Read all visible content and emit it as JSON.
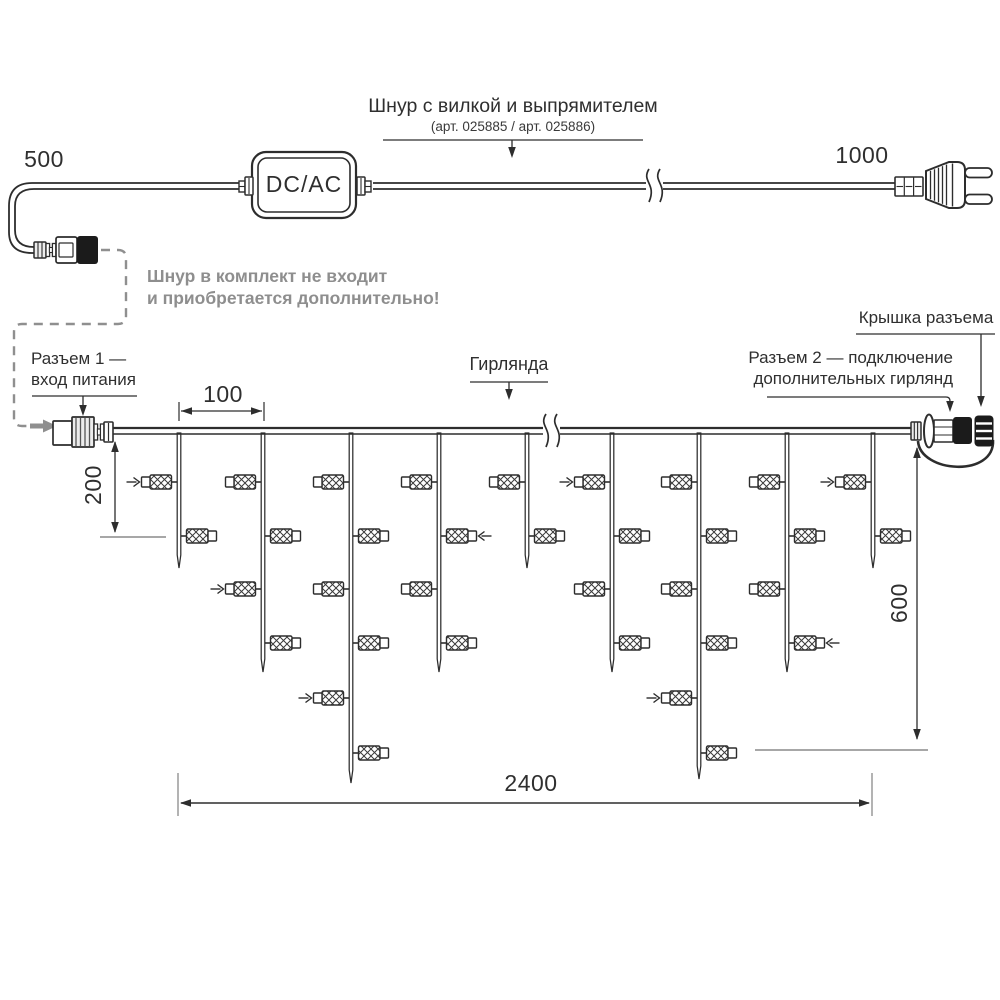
{
  "labels": {
    "cord_title": "Шнур с вилкой и выпрямителем",
    "cord_subtitle": "(арт. 025885 / арт. 025886)",
    "adapter": "DC/AC",
    "dim_500": "500",
    "dim_1000": "1000",
    "note_line1": "Шнур в комплект не входит",
    "note_line2": "и приобретается дополнительно!",
    "connector1_line1": "Разъем 1 —",
    "connector1_line2": "вход питания",
    "garland": "Гирлянда",
    "connector2_line1": "Разъем 2 — подключение",
    "connector2_line2": "дополнительных гирлянд",
    "cap_label": "Крышка разъема",
    "dim_100": "100",
    "dim_200": "200",
    "dim_600": "600",
    "dim_2400": "2400"
  },
  "colors": {
    "line": "#2d2d2d",
    "gray": "#8f8f8f",
    "ext": "#8a8a8a",
    "black_fill": "#1b1b1b",
    "rib_fill": "#ececec",
    "hatch": "#3a3a3a"
  },
  "diagram": {
    "wire": {
      "x1": 112,
      "x2": 911,
      "y_top": 428,
      "y_bot": 434,
      "break_x": 546
    },
    "power_cable": {
      "y_top": 183,
      "y_bot": 189,
      "break_x": 649
    },
    "lamp_levels": [
      482,
      536,
      589,
      643,
      698,
      753
    ],
    "drops": [
      {
        "x": 179,
        "tip": 568,
        "lamps": [
          {
            "y": 482,
            "side": "left",
            "marker": true
          },
          {
            "y": 536,
            "side": "right",
            "marker": false
          }
        ]
      },
      {
        "x": 263,
        "tip": 672,
        "lamps": [
          {
            "y": 482,
            "side": "left",
            "marker": false
          },
          {
            "y": 536,
            "side": "right",
            "marker": false
          },
          {
            "y": 589,
            "side": "left",
            "marker": true
          },
          {
            "y": 643,
            "side": "right",
            "marker": false
          }
        ]
      },
      {
        "x": 351,
        "tip": 783,
        "lamps": [
          {
            "y": 482,
            "side": "left",
            "marker": false
          },
          {
            "y": 536,
            "side": "right",
            "marker": false
          },
          {
            "y": 589,
            "side": "left",
            "marker": false
          },
          {
            "y": 643,
            "side": "right",
            "marker": false
          },
          {
            "y": 698,
            "side": "left",
            "marker": true
          },
          {
            "y": 753,
            "side": "right",
            "marker": false
          }
        ]
      },
      {
        "x": 439,
        "tip": 672,
        "lamps": [
          {
            "y": 482,
            "side": "left",
            "marker": false
          },
          {
            "y": 536,
            "side": "right",
            "marker": true
          },
          {
            "y": 589,
            "side": "left",
            "marker": false
          },
          {
            "y": 643,
            "side": "right",
            "marker": false
          }
        ]
      },
      {
        "x": 527,
        "tip": 568,
        "lamps": [
          {
            "y": 482,
            "side": "left",
            "marker": false
          },
          {
            "y": 536,
            "side": "right",
            "marker": false
          }
        ]
      },
      {
        "x": 612,
        "tip": 672,
        "lamps": [
          {
            "y": 482,
            "side": "left",
            "marker": true
          },
          {
            "y": 536,
            "side": "right",
            "marker": false
          },
          {
            "y": 589,
            "side": "left",
            "marker": false
          },
          {
            "y": 643,
            "side": "right",
            "marker": false
          }
        ]
      },
      {
        "x": 699,
        "tip": 779,
        "lamps": [
          {
            "y": 482,
            "side": "left",
            "marker": false
          },
          {
            "y": 536,
            "side": "right",
            "marker": false
          },
          {
            "y": 589,
            "side": "left",
            "marker": false
          },
          {
            "y": 643,
            "side": "right",
            "marker": false
          },
          {
            "y": 698,
            "side": "left",
            "marker": true
          },
          {
            "y": 753,
            "side": "right",
            "marker": false
          }
        ]
      },
      {
        "x": 787,
        "tip": 672,
        "lamps": [
          {
            "y": 482,
            "side": "left",
            "marker": false
          },
          {
            "y": 536,
            "side": "right",
            "marker": false
          },
          {
            "y": 589,
            "side": "left",
            "marker": false
          },
          {
            "y": 643,
            "side": "right",
            "marker": true
          }
        ]
      },
      {
        "x": 873,
        "tip": 568,
        "lamps": [
          {
            "y": 482,
            "side": "left",
            "marker": true
          },
          {
            "y": 536,
            "side": "right",
            "marker": false
          }
        ]
      }
    ],
    "dims": {
      "d100": {
        "x1": 179,
        "x2": 264,
        "y": 411,
        "tick_y1": 402,
        "tick_y2": 421
      },
      "d200": {
        "x": 115,
        "y1": 441,
        "y2": 533,
        "ext_y": 537,
        "ext_x1": 100,
        "ext_x2": 166
      },
      "d600": {
        "x": 917,
        "y1": 447,
        "y2": 740,
        "ext_y": 750,
        "ext_x1": 755,
        "ext_x2": 928
      },
      "d2400": {
        "x1": 179,
        "x2": 871,
        "y": 803,
        "ext_y1": 773,
        "ext_y2": 816
      }
    }
  }
}
